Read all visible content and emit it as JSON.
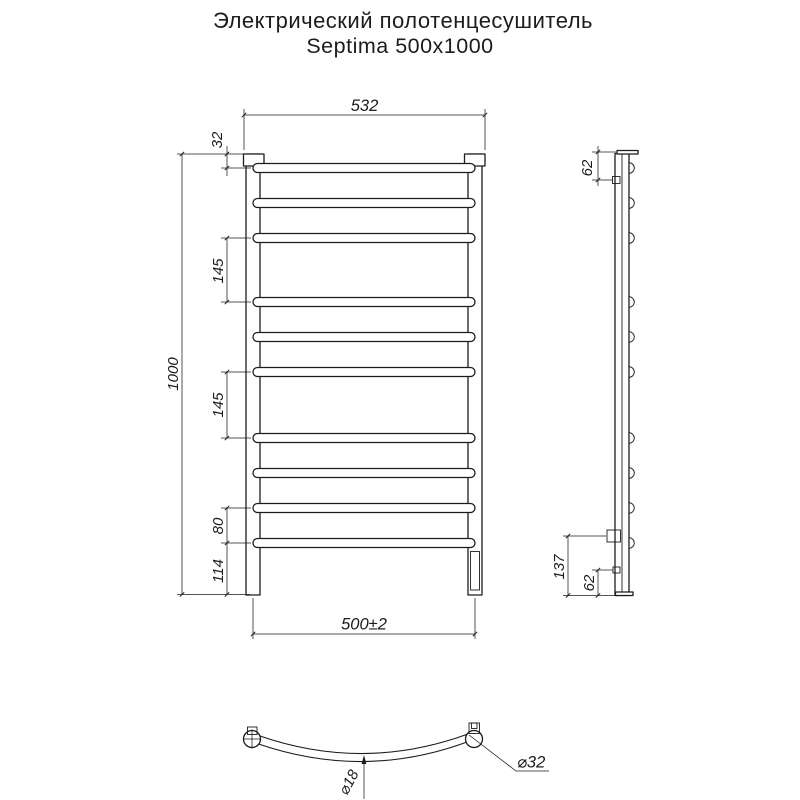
{
  "title": {
    "line1": "Электрический полотенцесушитель",
    "line2": "Septima 500x1000"
  },
  "front_view": {
    "rungs": {
      "count": 10,
      "centers_y": [
        168,
        203,
        238,
        302,
        337,
        372,
        438,
        473,
        508,
        543
      ]
    },
    "dimensions": {
      "overall_width": "532",
      "top_to_first_rung": "32",
      "overall_height": "1000",
      "upper_gap": "145",
      "middle_gap": "145",
      "lower_gap": "80",
      "last_rung_to_bottom": "114",
      "mounting_width": "500±2"
    }
  },
  "side_view": {
    "dimensions": {
      "top_bracket_offset": "62",
      "element_box_height": "137",
      "bottom_bracket_offset": "62"
    }
  },
  "bottom_view": {
    "dimensions": {
      "rung_tube_diameter": "⌀18",
      "collector_tube_diameter": "⌀32"
    }
  },
  "colors": {
    "line": "#1c1c1c",
    "background": "#ffffff"
  }
}
